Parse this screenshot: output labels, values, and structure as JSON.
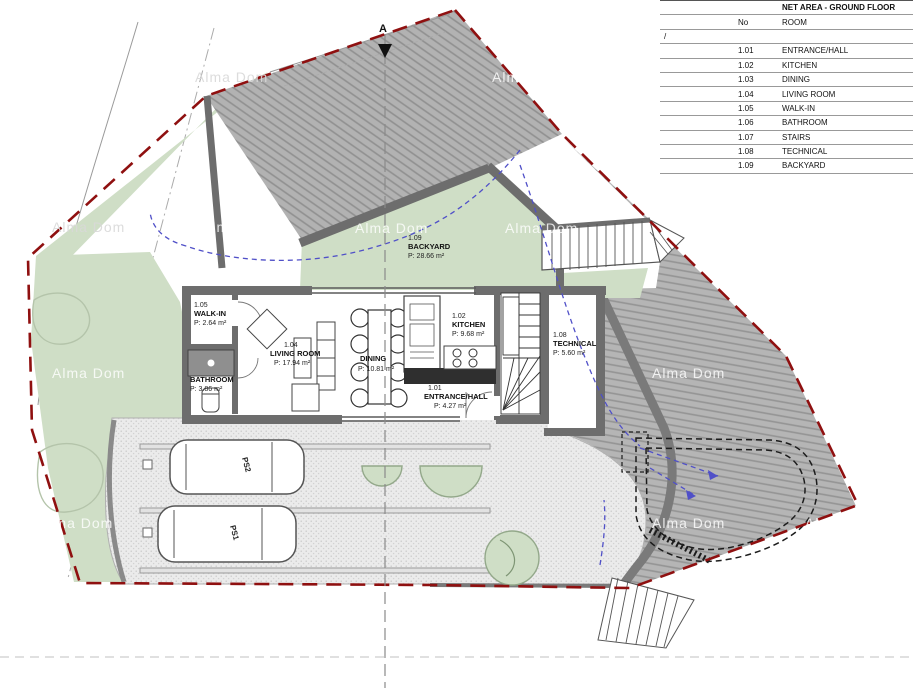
{
  "table": {
    "title": "NET AREA - GROUND FLOOR",
    "col_no": "No",
    "col_room": "ROOM",
    "slash_row": "/",
    "rows": [
      {
        "no": "1.01",
        "room": "ENTRANCE/HALL"
      },
      {
        "no": "1.02",
        "room": "KITCHEN"
      },
      {
        "no": "1.03",
        "room": "DINING"
      },
      {
        "no": "1.04",
        "room": "LIVING ROOM"
      },
      {
        "no": "1.05",
        "room": "WALK-IN"
      },
      {
        "no": "1.06",
        "room": "BATHROOM"
      },
      {
        "no": "1.07",
        "room": "STAIRS"
      },
      {
        "no": "1.08",
        "room": "TECHNICAL"
      },
      {
        "no": "1.09",
        "room": "BACKYARD"
      }
    ]
  },
  "plan": {
    "section_marker": "A",
    "watermark": "Alma Dom",
    "rooms": {
      "walk_in": {
        "no": "1.05",
        "name": "WALK-IN",
        "area": "P: 2.64 m²"
      },
      "bathroom": {
        "name": "BATHROOM",
        "area": "P: 3.86 m²"
      },
      "living": {
        "no": "1.04",
        "name": "LIVING ROOM",
        "area": "P: 17.94 m²"
      },
      "dining": {
        "name": "DINING",
        "area": "P: 10.81 m²"
      },
      "kitchen": {
        "no": "1.02",
        "name": "KITCHEN",
        "area": "P: 9.68 m²"
      },
      "entrance": {
        "no": "1.01",
        "name": "ENTRANCE/HALL",
        "area": "P: 4.27 m²"
      },
      "technical": {
        "no": "1.08",
        "name": "TECHNICAL",
        "area": "P: 5.60 m²"
      },
      "backyard": {
        "no": "1.09",
        "name": "BACKYARD",
        "area": "P: 28.66 m²"
      }
    },
    "parking": {
      "ps1": "PS1",
      "ps2": "PS2"
    }
  },
  "colors": {
    "boundary_red": "#8f1010",
    "hatch_gray": "#b5b5b5",
    "garden_green": "#cfdec6",
    "wall_gray": "#6d6d6d",
    "guide_blue": "#5050c8"
  }
}
